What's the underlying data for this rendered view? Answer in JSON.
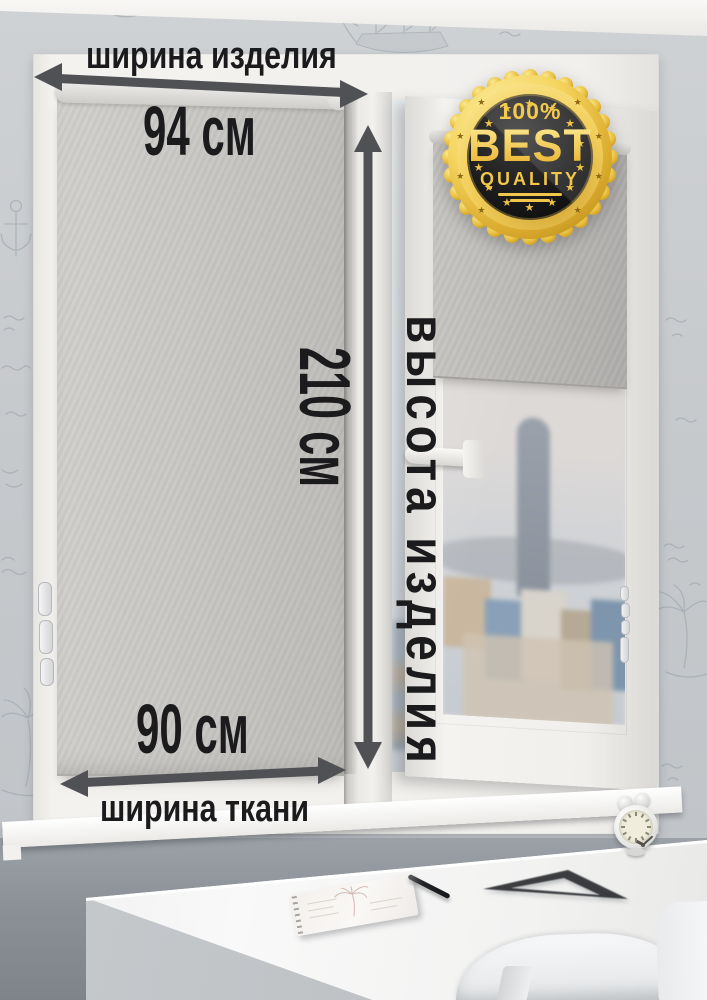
{
  "annotations": {
    "product_width": {
      "label": "ширина изделия",
      "value": "94 см"
    },
    "product_height": {
      "label": "высота изделия",
      "value": "210 см"
    },
    "fabric_width": {
      "label": "ширина ткани",
      "value": "90 см"
    }
  },
  "badge": {
    "percent": "100%",
    "title": "BEST",
    "subtitle": "QUALITY",
    "star_glyph": "★"
  },
  "colors": {
    "dimension_text": "#1b1b1d",
    "arrow": "#4f5155",
    "badge_gold": "#f2c243",
    "badge_gold_dark": "#8a6712",
    "blind_fabric": "#c6c4c1",
    "wallpaper": "#c7cacc"
  }
}
